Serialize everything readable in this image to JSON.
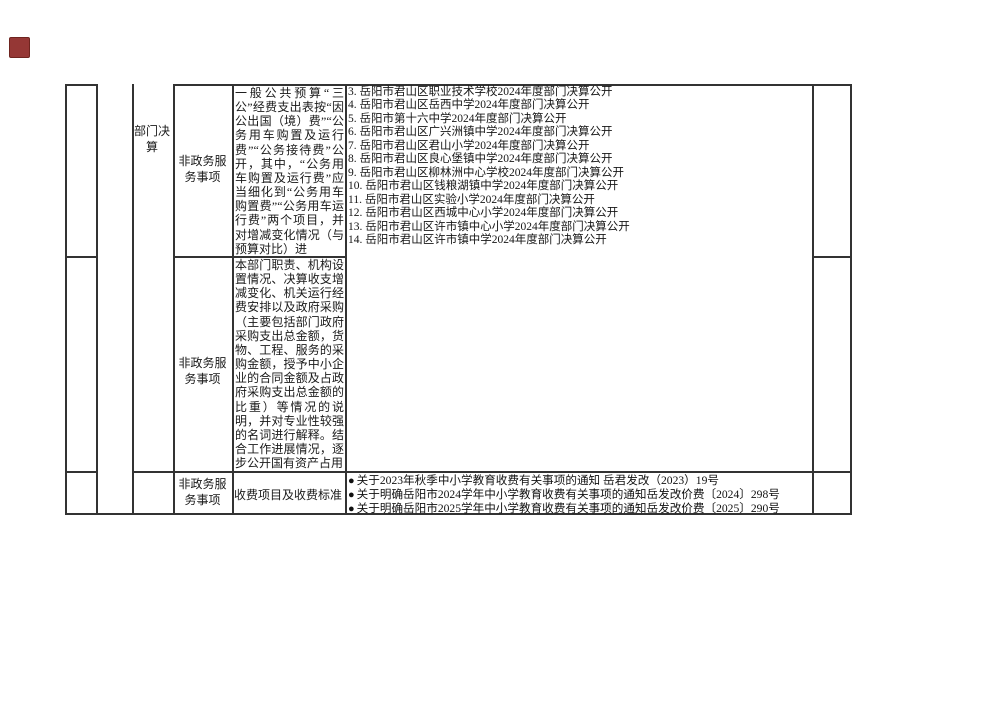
{
  "colors": {
    "border": "#333333",
    "marker": "#953735",
    "text": "#1a1a1a"
  },
  "marker": {
    "glyph": ""
  },
  "table": {
    "section": {
      "label": "部门决算"
    },
    "rows": [
      {
        "category": "非政务服务事项",
        "item": "一般公共预算“三公”经费支出表按“因公出国（境）费”“公务用车购置及运行费”“公务接待费”公开，其中，“公务用车购置及运行费”应当细化到“公务用车购置费”“公务用车运行费”两个项目，并对增减变化情况（与预算对比）进"
      },
      {
        "category": "非政务服务事项",
        "item": "本部门职责、机构设置情况、决算收支增减变化、机关运行经费安排以及政府采购（主要包括部门政府采购支出总金额，货物、工程、服务的采购金额，授予中小企业的合同金额及占政府采购支出总金额的比重）等情况的说明，并对专业性较强的名词进行解释。结合工作进展情况，逐步公开国有资产占用"
      },
      {
        "category": "非政务服务事项",
        "item": "收费项目及收费标准"
      }
    ],
    "disclosures": [
      "3. 岳阳市君山区职业技术学校2024年度部门决算公开",
      "4. 岳阳市君山区岳西中学2024年度部门决算公开",
      "5. 岳阳市第十六中学2024年度部门决算公开",
      "6. 岳阳市君山区广兴洲镇中学2024年度部门决算公开",
      "7. 岳阳市君山区君山小学2024年度部门决算公开",
      "8. 岳阳市君山区良心堡镇中学2024年度部门决算公开",
      "9. 岳阳市君山区柳林洲中心学校2024年度部门决算公开",
      "10. 岳阳市君山区钱粮湖镇中学2024年度部门决算公开",
      "11. 岳阳市君山区实验小学2024年度部门决算公开",
      "12. 岳阳市君山区西城中心小学2024年度部门决算公开",
      "13. 岳阳市君山区许市镇中心小学2024年度部门决算公开",
      "14. 岳阳市君山区许市镇中学2024年度部门决算公开"
    ],
    "notices": [
      {
        "bullet": "●",
        "text": "关于2023年秋季中小学教育收费有关事项的通知 岳君发改（2023）19号"
      },
      {
        "bullet": "●",
        "text": "关于明确岳阳市2024学年中小学教育收费有关事项的通知岳发改价费〔2024〕298号"
      },
      {
        "bullet": "●",
        "text": "关于明确岳阳市2025学年中小学教育收费有关事项的通知岳发改价费〔2025〕290号"
      }
    ]
  }
}
